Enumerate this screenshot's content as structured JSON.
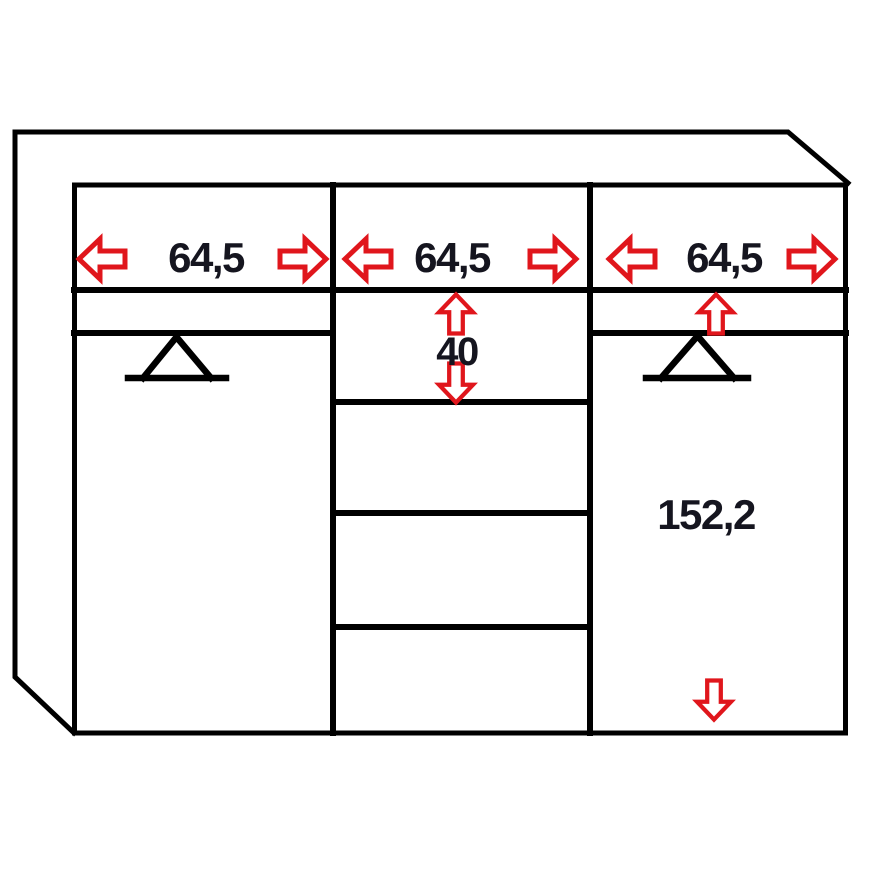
{
  "diagram": {
    "colors": {
      "background": "#ffffff",
      "line": "#000000",
      "text": "#15151f",
      "arrow": "#e0161c",
      "arrow_fill": "#ffffff"
    },
    "labels": {
      "left_section_width": "64,5",
      "middle_section_width": "64,5",
      "right_section_width": "64,5",
      "middle_drawer_height": "40",
      "right_door_height": "152,2"
    },
    "icons": {
      "width_arrow_left": "hollow-block-arrow-left",
      "width_arrow_right": "hollow-block-arrow-right",
      "height_arrow_up": "hollow-block-arrow-up",
      "height_arrow_down": "hollow-block-arrow-down",
      "clothes_rail": "triangle-rail-symbol"
    }
  }
}
